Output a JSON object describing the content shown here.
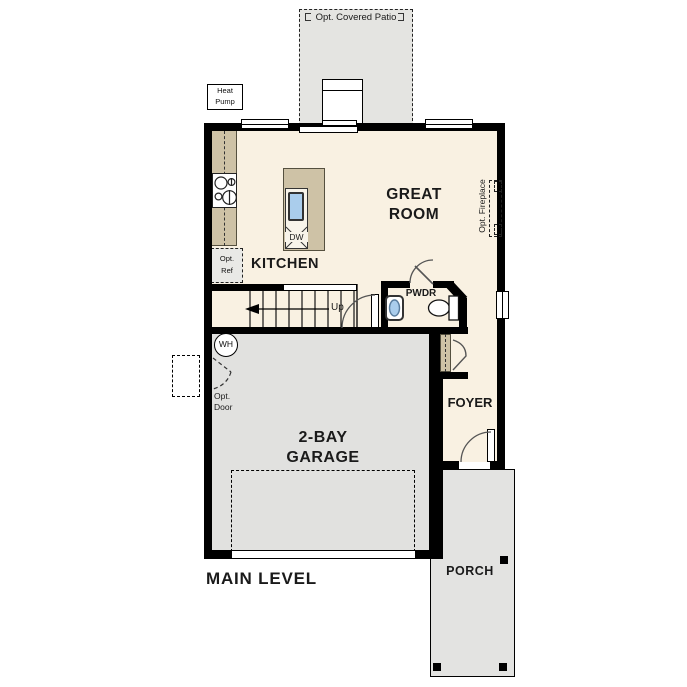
{
  "plan": {
    "title": "MAIN LEVEL",
    "labels": {
      "covered_patio": "Opt. Covered Patio",
      "heat_pump": [
        "Heat",
        "Pump"
      ],
      "kitchen": "KITCHEN",
      "great_room": [
        "GREAT",
        "ROOM"
      ],
      "opt_ref": [
        "Opt.",
        "Ref"
      ],
      "opt_fireplace": "Opt. Fireplace",
      "dishwasher": "DW",
      "stairs_up": "Up",
      "powder_room": "PWDR",
      "water_heater": "WH",
      "opt_door": [
        "Opt.",
        "Door"
      ],
      "garage": [
        "2-BAY",
        "GARAGE"
      ],
      "foyer": "FOYER",
      "porch": "PORCH"
    },
    "colors": {
      "floor": "#f9f1e2",
      "cabinet": "#cec2a6",
      "garage_floor": "#e1e1df",
      "patio": "#e4e4e1",
      "porch": "#e3e3e1",
      "sink_blue": "#aacdec",
      "wall": "#000000",
      "background": "#ffffff"
    }
  }
}
